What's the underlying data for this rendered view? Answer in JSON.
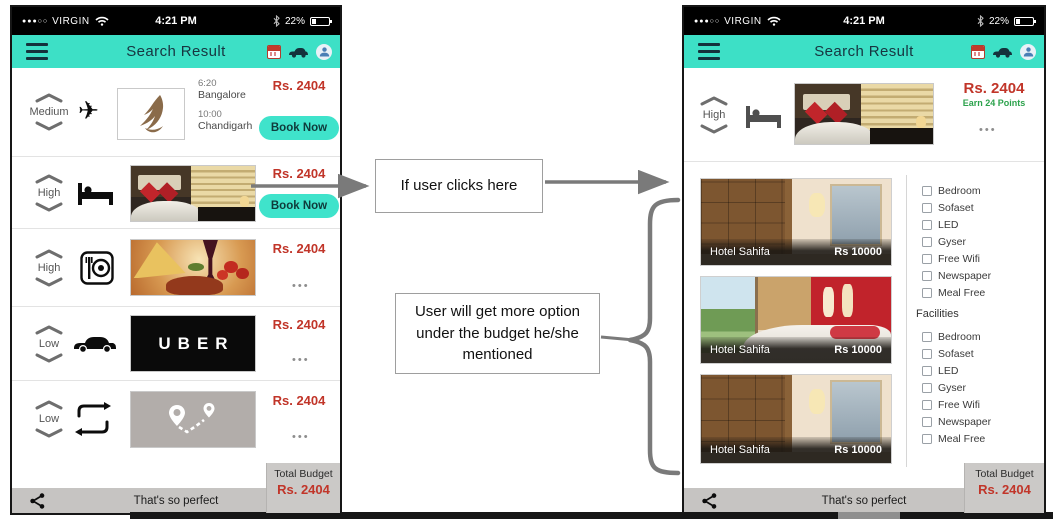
{
  "colors": {
    "teal": "#3DE0C6",
    "price_red": "#C13529",
    "earn_green": "#2CA24C",
    "uber_black": "#0A0A0A"
  },
  "status_bar": {
    "signal_dots": "●●●○○",
    "carrier": "VIRGIN",
    "time": "4:21 PM",
    "battery_percent": "22%"
  },
  "header": {
    "title": "Search Result"
  },
  "left_phone": {
    "rows": [
      {
        "priority": "Medium",
        "category": "flight",
        "depart_time": "6:20",
        "depart_city": "Bangalore",
        "arrive_time": "10:00",
        "arrive_city": "Chandigarh",
        "price": "Rs. 2404",
        "action": "Book Now"
      },
      {
        "priority": "High",
        "category": "hotel",
        "price": "Rs. 2404",
        "action": "Book Now"
      },
      {
        "priority": "High",
        "category": "restaurant",
        "price": "Rs. 2404",
        "more": "•••"
      },
      {
        "priority": "Low",
        "category": "cab",
        "brand": "UBER",
        "price": "Rs. 2404",
        "more": "•••"
      },
      {
        "priority": "Low",
        "category": "route",
        "price": "Rs. 2404",
        "more": "•••"
      }
    ],
    "total_budget": {
      "label": "Total Budget",
      "value": "Rs. 2404"
    },
    "footer": {
      "text": "That's so perfect"
    }
  },
  "annotations": {
    "click_note": "If user clicks here",
    "options_note": "User will get more option under the budget he/she mentioned"
  },
  "right_phone": {
    "top_row": {
      "priority": "High",
      "price": "Rs. 2404",
      "earn": "Earn 24 Points",
      "more": "•••"
    },
    "hotels": [
      {
        "name": "Hotel Sahifa",
        "price": "Rs 10000"
      },
      {
        "name": "Hotel Sahifa",
        "price": "Rs 10000"
      },
      {
        "name": "Hotel Sahifa",
        "price": "Rs 10000"
      }
    ],
    "amenities": [
      "Bedroom",
      "Sofaset",
      "LED",
      "Gyser",
      "Free Wifi",
      "Newspaper",
      "Meal Free"
    ],
    "facilities": {
      "label": "Facilities",
      "items": [
        "Bedroom",
        "Sofaset",
        "LED",
        "Gyser",
        "Free Wifi",
        "Newspaper",
        "Meal Free"
      ]
    },
    "total_budget": {
      "label": "Total Budget",
      "value": "Rs. 2404"
    },
    "footer": {
      "text": "That's so perfect"
    }
  }
}
